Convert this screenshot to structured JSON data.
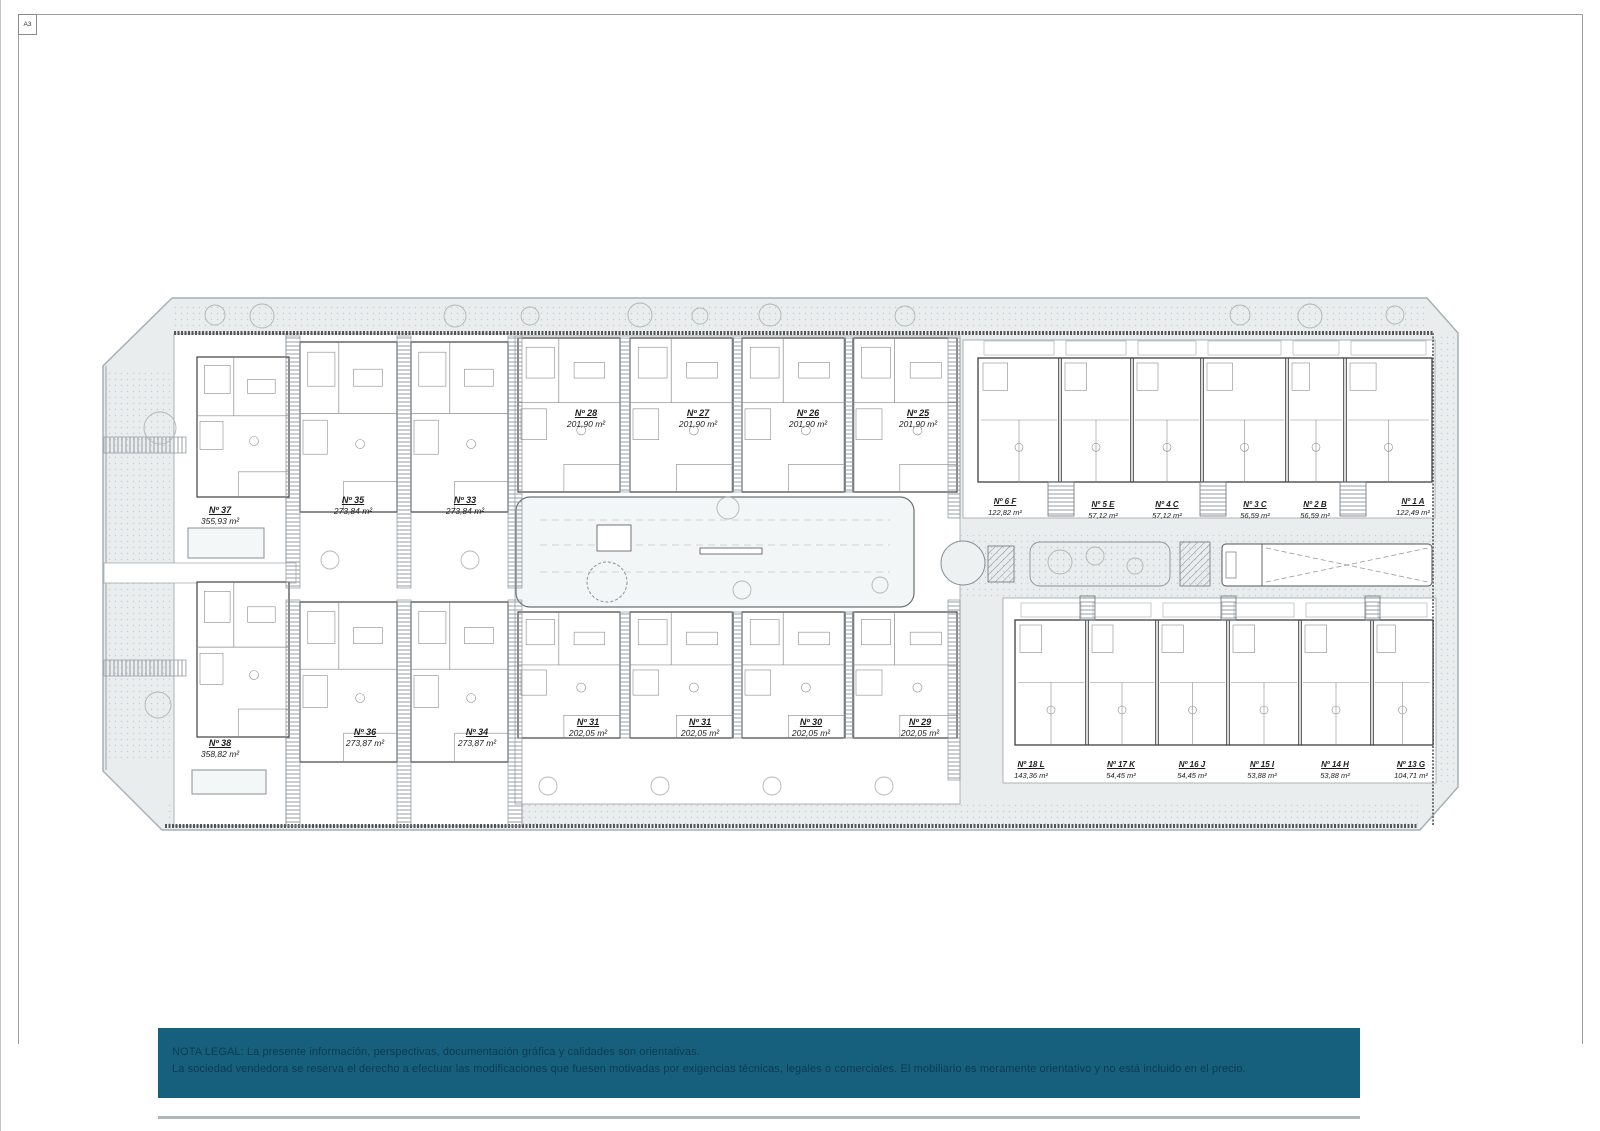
{
  "page": {
    "sheet_label": "A3"
  },
  "colors": {
    "banner_bg": "#16607e",
    "banner_text": "#0d3a52",
    "site_fill": "#e9edee",
    "plan_line": "#5a5f63"
  },
  "legal": {
    "line1": "NOTA LEGAL: La presente información, perspectivas, documentación gráfica y calidades son orientativas.",
    "line2": "La sociedad vendedora se reserva el derecho a efectuar las modificaciones que fuesen motivadas por exigencias técnicas, legales o comerciales. El mobiliario es meramente orientativo y no está incluido en el precio."
  },
  "units": [
    {
      "id": "Nº 37",
      "area": "355,93 m²"
    },
    {
      "id": "Nº 35",
      "area": "273,84 m²"
    },
    {
      "id": "Nº 33",
      "area": "273,84 m²"
    },
    {
      "id": "Nº 28",
      "area": "201,90 m²"
    },
    {
      "id": "Nº 27",
      "area": "201,90 m²"
    },
    {
      "id": "Nº 26",
      "area": "201,90 m²"
    },
    {
      "id": "Nº 25",
      "area": "201,90 m²"
    },
    {
      "id": "Nº 6 F",
      "area": "122,82 m²"
    },
    {
      "id": "Nº 5 E",
      "area": "57,12 m²"
    },
    {
      "id": "Nº 4 C",
      "area": "57,12 m²"
    },
    {
      "id": "Nº 3 C",
      "area": "56,59 m²"
    },
    {
      "id": "Nº 2 B",
      "area": "56,59 m²"
    },
    {
      "id": "Nº 1 A",
      "area": "122,49 m²"
    },
    {
      "id": "Nº 38",
      "area": "358,82 m²"
    },
    {
      "id": "Nº 36",
      "area": "273,87 m²"
    },
    {
      "id": "Nº 34",
      "area": "273,87 m²"
    },
    {
      "id": "Nº 31",
      "area": "202,05 m²"
    },
    {
      "id": "Nº 31",
      "area": "202,05 m²"
    },
    {
      "id": "Nº 30",
      "area": "202,05 m²"
    },
    {
      "id": "Nº 29",
      "area": "202,05 m²"
    },
    {
      "id": "Nº 18 L",
      "area": "143,36 m²"
    },
    {
      "id": "Nº 17 K",
      "area": "54,45 m²"
    },
    {
      "id": "Nº 16 J",
      "area": "54,45 m²"
    },
    {
      "id": "Nº 15 I",
      "area": "53,88 m²"
    },
    {
      "id": "Nº 14 H",
      "area": "53,88 m²"
    },
    {
      "id": "Nº 13 G",
      "area": "104,71 m²"
    }
  ]
}
